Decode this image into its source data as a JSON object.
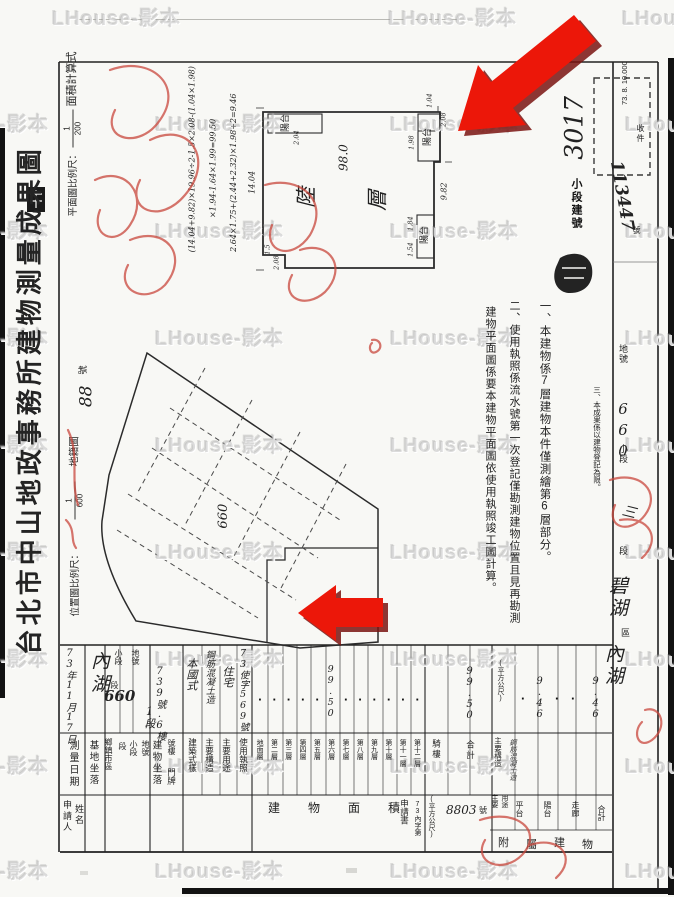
{
  "watermark": {
    "text": "LHouse-影本"
  },
  "title": "台北市中山地政事務所建物測量成果圖",
  "receipt": {
    "label": "收件",
    "number": "113447",
    "suffix": "號",
    "print_code": "73. 8. 10.000"
  },
  "building_no_stamp": {
    "label": "小段建號",
    "value": "3017"
  },
  "plan_header": {
    "calc_label": "面積計算式",
    "scale_label": "平面圖比例尺：",
    "scale_num": "1",
    "scale_den": "200",
    "formulas": [
      "(14.04+9.82)×19.96÷2-1.5×2.08-(1.04×1.98)",
      "×1.94-1.64×1.99=99.50",
      "2.64×1.75+(2.44+2.32)×1.98÷2=9.46"
    ]
  },
  "floor_plan": {
    "room_big_1": "陸",
    "room_big_2": "層",
    "area_value": "98.0",
    "balcony_tl": "陽台",
    "balcony_tr": "陽台",
    "balcony_mr": "陽台",
    "dim_left": "14.04",
    "dim_right": "9.82",
    "dim_tr_1": "1.04",
    "dim_tr_2": "2.08",
    "dim_tr_3": "1.98",
    "dim_mr_1": "1.84",
    "dim_mr_2": "1.54",
    "dim_bl_1": "1.5",
    "dim_bl_2": "2.08",
    "dim_tl": "2.04"
  },
  "site_plan": {
    "scale_label": "位置圖比例尺：",
    "scale_num": "1",
    "scale_den": "600",
    "sheet_label": "地籍圖",
    "sheet_no": "88",
    "sheet_suffix": "號",
    "lot_no": "660"
  },
  "notes": {
    "n1": "一、本建物係7層建物本件僅測繪第6層部分。",
    "n2a": "二、使用執照係流水號第一次登記僅勘測建物位置且見再勘測",
    "n2b": "建物平面圖係要本建物平面圖依使用執照竣工圖計算。",
    "n3": "三、本成果係以建物登記為限。"
  },
  "location_strip": [
    {
      "text": "地號",
      "hand": false
    },
    {
      "text": "660",
      "hand": true
    },
    {
      "text": "小段",
      "hand": false
    },
    {
      "text": "三",
      "hand": true
    },
    {
      "text": "段",
      "hand": false
    },
    {
      "text": "碧湖",
      "hand": true
    },
    {
      "text": "區",
      "hand": false
    },
    {
      "text": "內湖",
      "hand": true
    }
  ],
  "table": {
    "survey_date_label": "測量日期",
    "survey_date": "73年11月17日",
    "applicant_label": "申請人",
    "applicant_name_label": "姓名",
    "site_label": "基地坐落",
    "district_label": "鄉鎮市區",
    "district": "內湖",
    "sec_label": "段",
    "subsec_label": "小段",
    "lot_label": "地號",
    "lot": "660",
    "bldg_site_label": "建物坐落",
    "door_label": "門牌",
    "door_no_label": "號樓",
    "door_sec": "1段",
    "door_value": "739號.6樓",
    "style_label": "建築式樣",
    "style": "本國式",
    "construction_label": "主要構造",
    "construction": "鋼筋混凝土造",
    "use_label": "主要用途",
    "use": "住宅",
    "license_label": "使用執照",
    "license": "73使字569號",
    "area_band": [
      "建",
      "物",
      "面",
      "積"
    ],
    "area_unit": "(平方公尺)",
    "floors": [
      {
        "label": "地面層",
        "value": "·"
      },
      {
        "label": "第二層",
        "value": "·"
      },
      {
        "label": "第三層",
        "value": "·"
      },
      {
        "label": "第四層",
        "value": "·"
      },
      {
        "label": "第五層",
        "value": "·"
      },
      {
        "label": "第六層",
        "value": "99.50"
      },
      {
        "label": "第七層",
        "value": "·"
      },
      {
        "label": "第八層",
        "value": "·"
      },
      {
        "label": "第九層",
        "value": "·"
      },
      {
        "label": "第十層",
        "value": "·"
      },
      {
        "label": "第十一層",
        "value": "·"
      },
      {
        "label": "第十二層",
        "value": "·"
      }
    ],
    "arcade_label": "騎樓",
    "total_label": "合計",
    "total_value": "99.50",
    "application": {
      "label": "申請書",
      "prefix": "73內字第",
      "number": "8803",
      "suffix": "號"
    },
    "annex": {
      "band": [
        "附",
        "屬",
        "建",
        "物"
      ],
      "construction_label": "主要構造",
      "construction_value": "鋼筋混凝土造",
      "use_label_1": "主要",
      "use_label_2": "用途",
      "unit": "(平方公尺)",
      "rows": [
        {
          "label": "平台",
          "value": "·"
        },
        {
          "label": "陽台",
          "value": "9.46"
        },
        {
          "label": "走廊",
          "value": "·"
        },
        {
          "label": "花台",
          "value": "·"
        },
        {
          "label": "合計",
          "value": "9.46"
        }
      ]
    }
  }
}
